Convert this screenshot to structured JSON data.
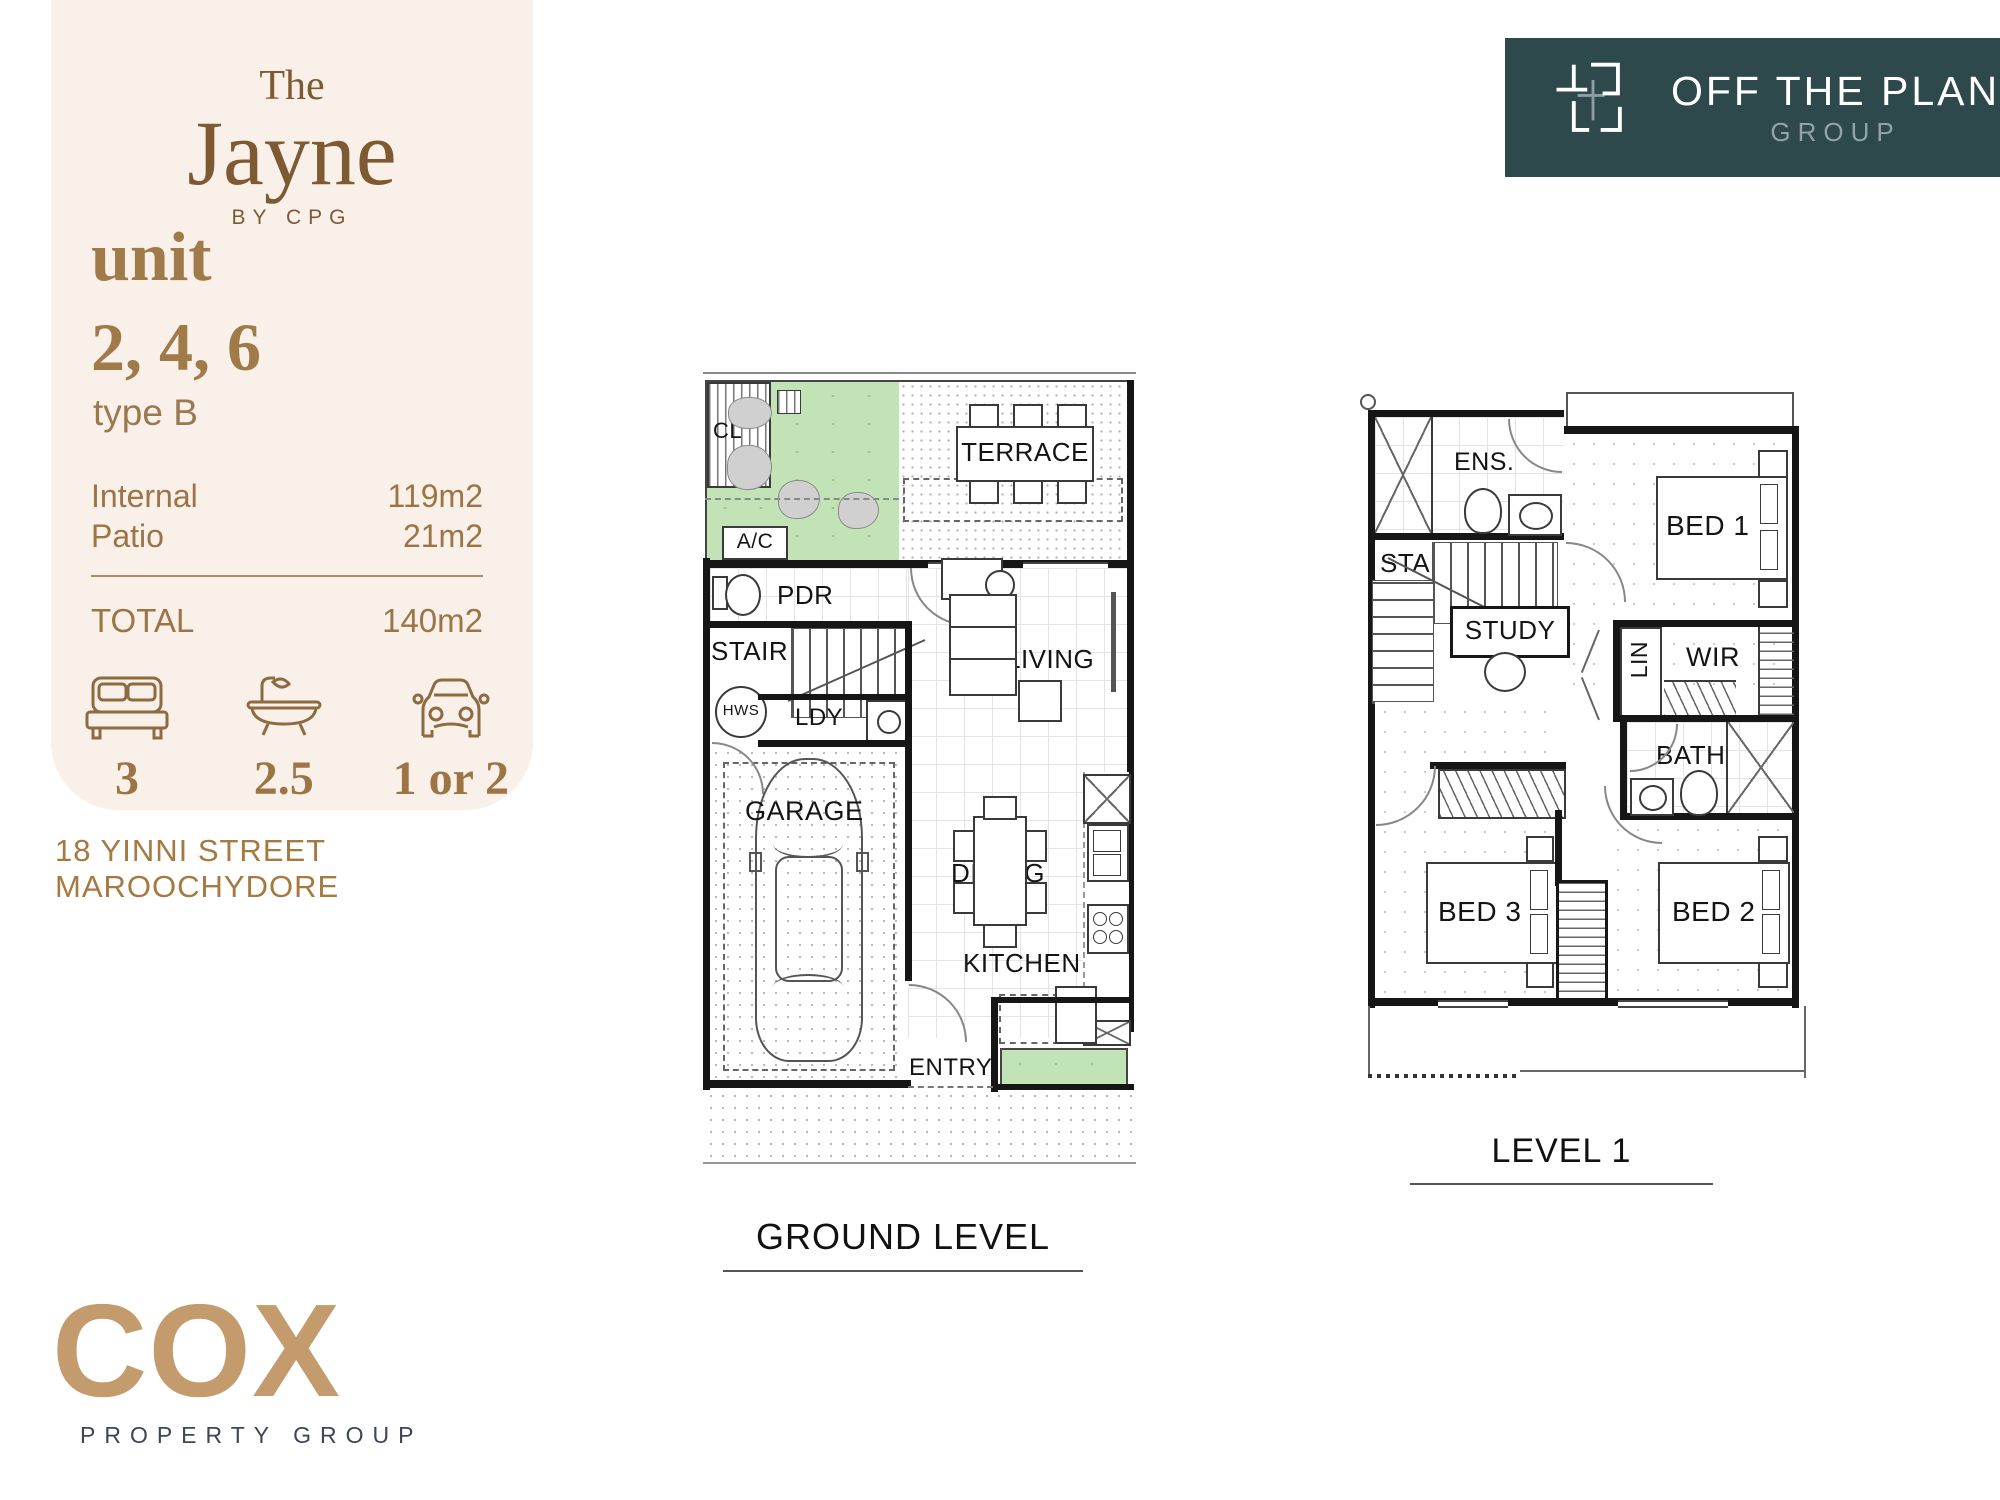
{
  "side_panel": {
    "bg": "#f9f1e9",
    "brand": {
      "the": "The",
      "name": "Jayne",
      "byline": "BY CPG"
    },
    "unit_word": "unit",
    "unit_numbers": "2, 4, 6",
    "unit_type": "type B",
    "areas": [
      {
        "label": "Internal",
        "value": "119m2"
      },
      {
        "label": "Patio",
        "value": "21m2"
      }
    ],
    "total": {
      "label": "TOTAL",
      "value": "140m2"
    },
    "features": [
      {
        "icon": "bed-icon",
        "value": "3"
      },
      {
        "icon": "bath-icon",
        "value": "2.5"
      },
      {
        "icon": "car-icon",
        "value": "1 or 2"
      }
    ]
  },
  "address": "18 YINNI STREET MAROOCHYDORE",
  "otp_logo": {
    "bg": "#2d494c",
    "title": "OFF THE PLAN",
    "subtitle": "GROUP"
  },
  "cox_logo": {
    "name": "COX",
    "tagline": "PROPERTY GROUP"
  },
  "floorplans": {
    "ground": {
      "title": "GROUND LEVEL",
      "rooms": {
        "cl": "CL",
        "terrace": "TERRACE",
        "ac": "A/C",
        "pdr": "PDR",
        "stair": "STAIR",
        "hws": "HWS",
        "ldy": "LDY",
        "garage": "GARAGE",
        "living": "LIVING",
        "dining": "DINING",
        "kitchen": "KITCHEN",
        "entry": "ENTRY"
      }
    },
    "level1": {
      "title": "LEVEL 1",
      "rooms": {
        "ens": "ENS.",
        "stair": "STAIR",
        "study": "STUDY",
        "bed1": "BED 1",
        "lin": "LIN",
        "wir": "WIR",
        "bath": "BATH",
        "bed3": "BED 3",
        "bed2": "BED 2"
      }
    }
  },
  "colors": {
    "accent_brown": "#8d6a3f",
    "accent_brown_light": "#a07a49",
    "cream": "#f9f1e9",
    "grass_green": "#c2e3b6",
    "teal": "#2d494c",
    "cox_tan": "#c49b6d",
    "cox_navy": "#3d4557"
  }
}
